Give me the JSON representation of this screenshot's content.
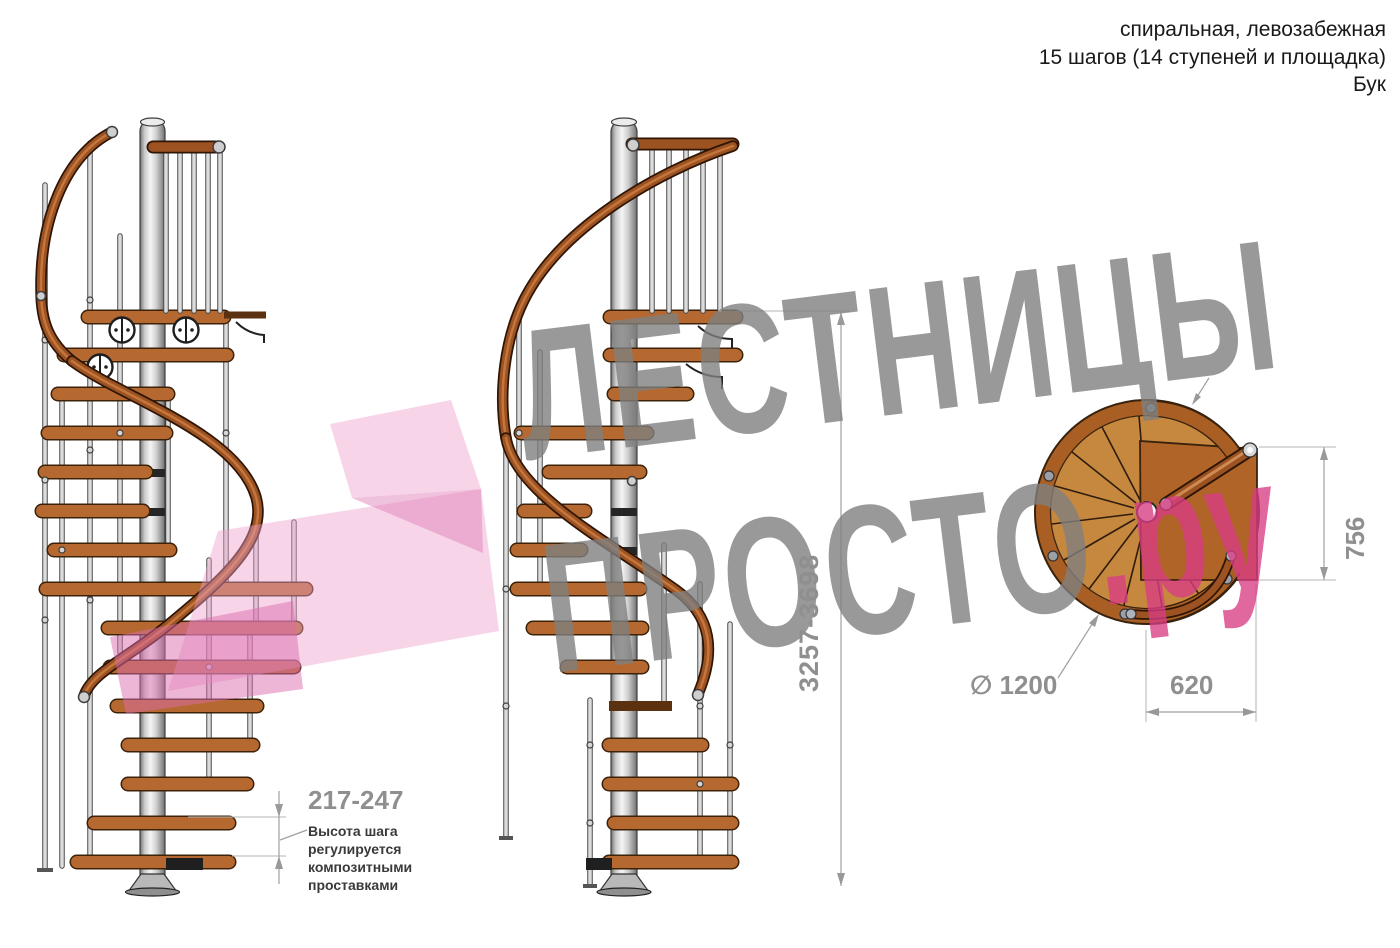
{
  "header": {
    "line1": "спиральная, левозабежная",
    "line2": "15 шагов (14 ступеней и площадка)",
    "line3": "Бук"
  },
  "watermark": {
    "line1": "ЛЕСТНИЦЫ",
    "line2": "ПРОСТО",
    "suffix": ".ру"
  },
  "dimensions": {
    "total_height": "3257-3698",
    "step_height": "217-247",
    "landing_depth": "756",
    "landing_width": "620",
    "diameter": "∅ 1200",
    "note_lines": [
      "Высота шага",
      "регулируется",
      "композитными",
      "проставками"
    ]
  },
  "colors": {
    "wood": "#b5682f",
    "rail": "#9c5221",
    "pole": "#c9c9c9",
    "watermark_gray": "#808080",
    "watermark_pink": "#d83c84",
    "arrow_pink": "#eda0cc",
    "dim_gray": "#8f8f8f"
  }
}
